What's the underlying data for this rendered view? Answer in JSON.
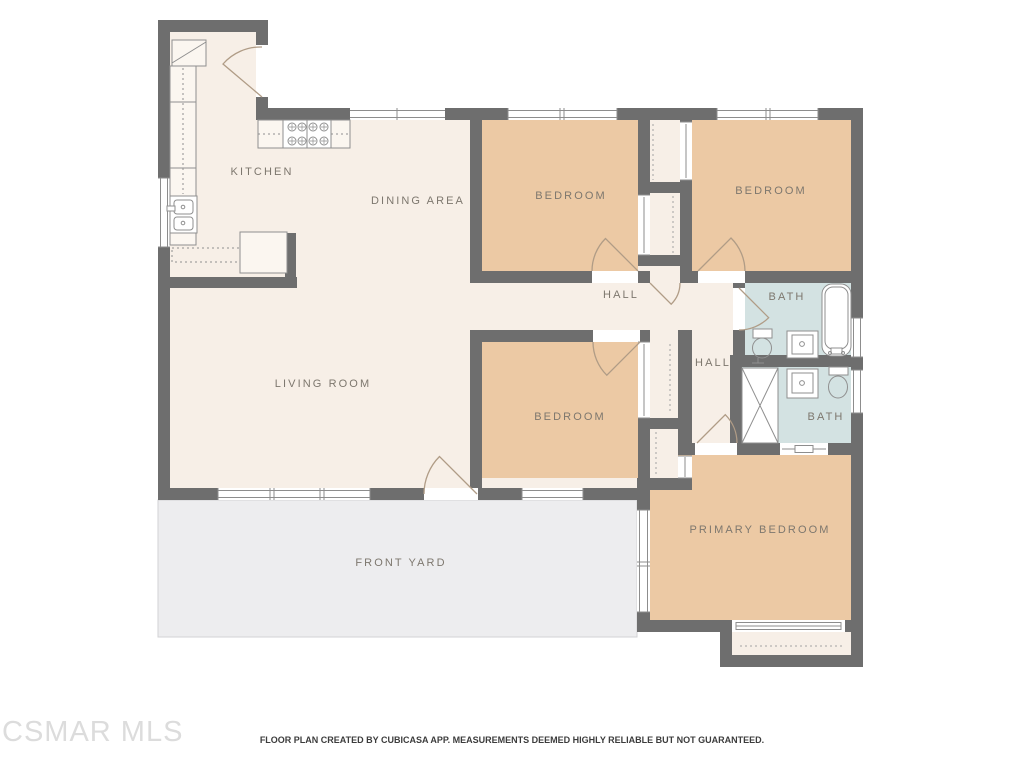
{
  "document": {
    "type": "residential floor plan"
  },
  "rooms": {
    "kitchen": {
      "label": "KITCHEN"
    },
    "dining_area": {
      "label": "DINING AREA"
    },
    "living_room": {
      "label": "LIVING ROOM"
    },
    "bedroom_top_left": {
      "label": "BEDROOM"
    },
    "bedroom_top_right": {
      "label": "BEDROOM"
    },
    "bedroom_middle": {
      "label": "BEDROOM"
    },
    "primary_bedroom": {
      "label": "PRIMARY BEDROOM"
    },
    "hall_upper": {
      "label": "HALL"
    },
    "hall_lower": {
      "label": "HALL"
    },
    "bath_upper": {
      "label": "BATH"
    },
    "bath_lower": {
      "label": "BATH"
    },
    "front_yard": {
      "label": "FRONT YARD"
    }
  },
  "fixtures": [
    "refrigerator-icon",
    "kitchen-counter-icon",
    "stove-icon",
    "kitchen-sink-icon",
    "toilet-icon",
    "bathtub-icon",
    "vanity-sink-icon",
    "shower-icon",
    "closet-icon",
    "door-arc-icon",
    "window-icon",
    "sliding-door-icon"
  ],
  "footer": {
    "watermark": "CSMAR MLS",
    "disclaimer": "FLOOR PLAN CREATED BY CUBICASA APP. MEASUREMENTS DEEMED HIGHLY RELIABLE BUT NOT GUARANTEED."
  },
  "colors": {
    "wall": "#6e6e6e",
    "floor_common": "#f7efe7",
    "floor_bedroom": "#ecc9a4",
    "floor_bath": "#d3e2e2",
    "front_yard": "#ededef",
    "label_text": "#7d776e",
    "fixture_line": "#8f8f8f",
    "door_arc": "#b09c86",
    "watermark": "#dcdcdc",
    "disclaimer_text": "#3c3c3c"
  }
}
